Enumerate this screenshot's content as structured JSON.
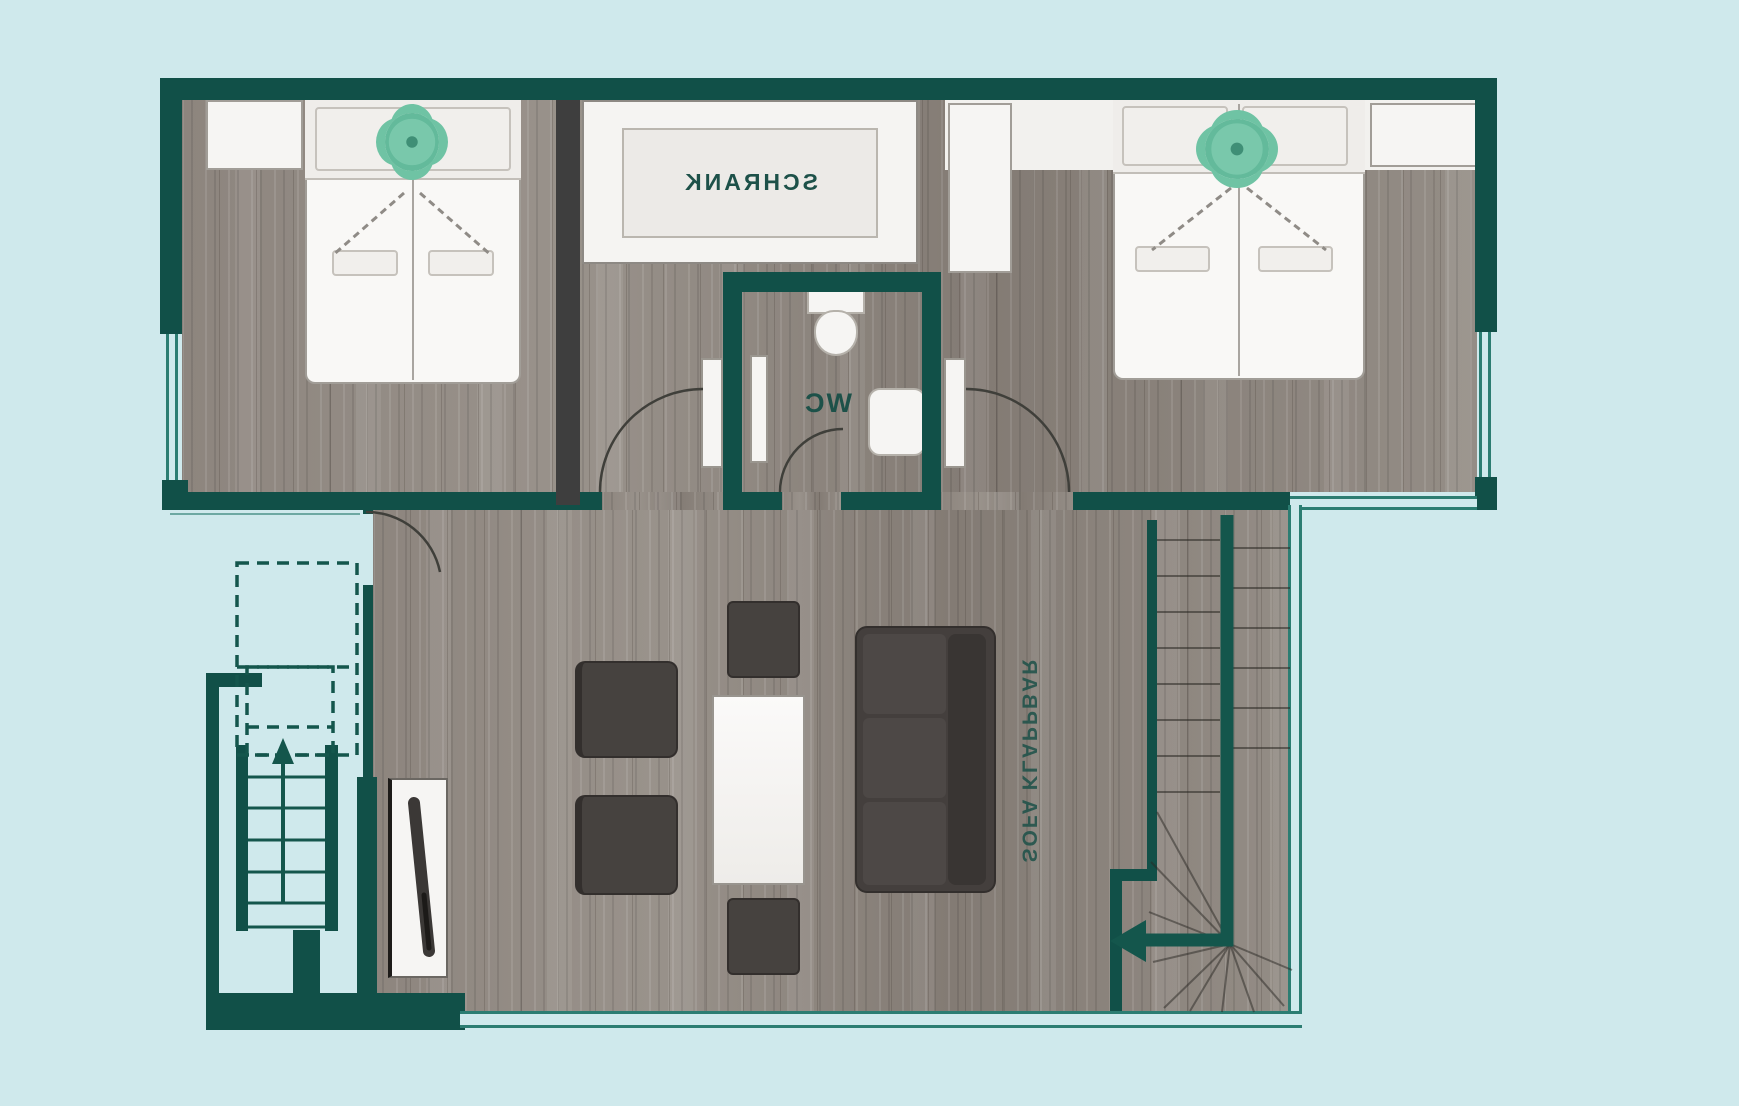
{
  "floorplan": {
    "mirrored": true,
    "labels": {
      "closet": "SCHRANK",
      "wc": "WC",
      "sofa": "SOFA KLAPPBAR"
    },
    "colors": {
      "background": "#cfe9ec",
      "wall": "#115048",
      "window_line": "#2c7d72",
      "floor_wood": "#8f8780",
      "white_furniture": "#f6f5f3",
      "dark_furniture": "#46423f",
      "plant_accent": "#79c8ab",
      "label_text": "#1d5149"
    },
    "rooms": [
      {
        "id": "bedroom-left",
        "furniture": [
          "double-bed",
          "nightstand",
          "plant"
        ]
      },
      {
        "id": "closet",
        "label": "SCHRANK"
      },
      {
        "id": "wc",
        "label": "WC",
        "furniture": [
          "toilet",
          "sink"
        ]
      },
      {
        "id": "bedroom-right",
        "furniture": [
          "double-bed",
          "nightstand",
          "nightstand",
          "plant"
        ]
      },
      {
        "id": "living-room",
        "label": "SOFA KLAPPBAR",
        "furniture": [
          "sofa-bed",
          "coffee-table",
          "armchair",
          "armchair",
          "stool",
          "stool",
          "tv"
        ]
      },
      {
        "id": "staircase-interior",
        "furniture": [
          "winder-stairs",
          "handrail",
          "direction-arrow"
        ]
      },
      {
        "id": "staircase-entry",
        "furniture": [
          "steps",
          "direction-arrow",
          "dashed-overhead-outline"
        ]
      }
    ]
  }
}
